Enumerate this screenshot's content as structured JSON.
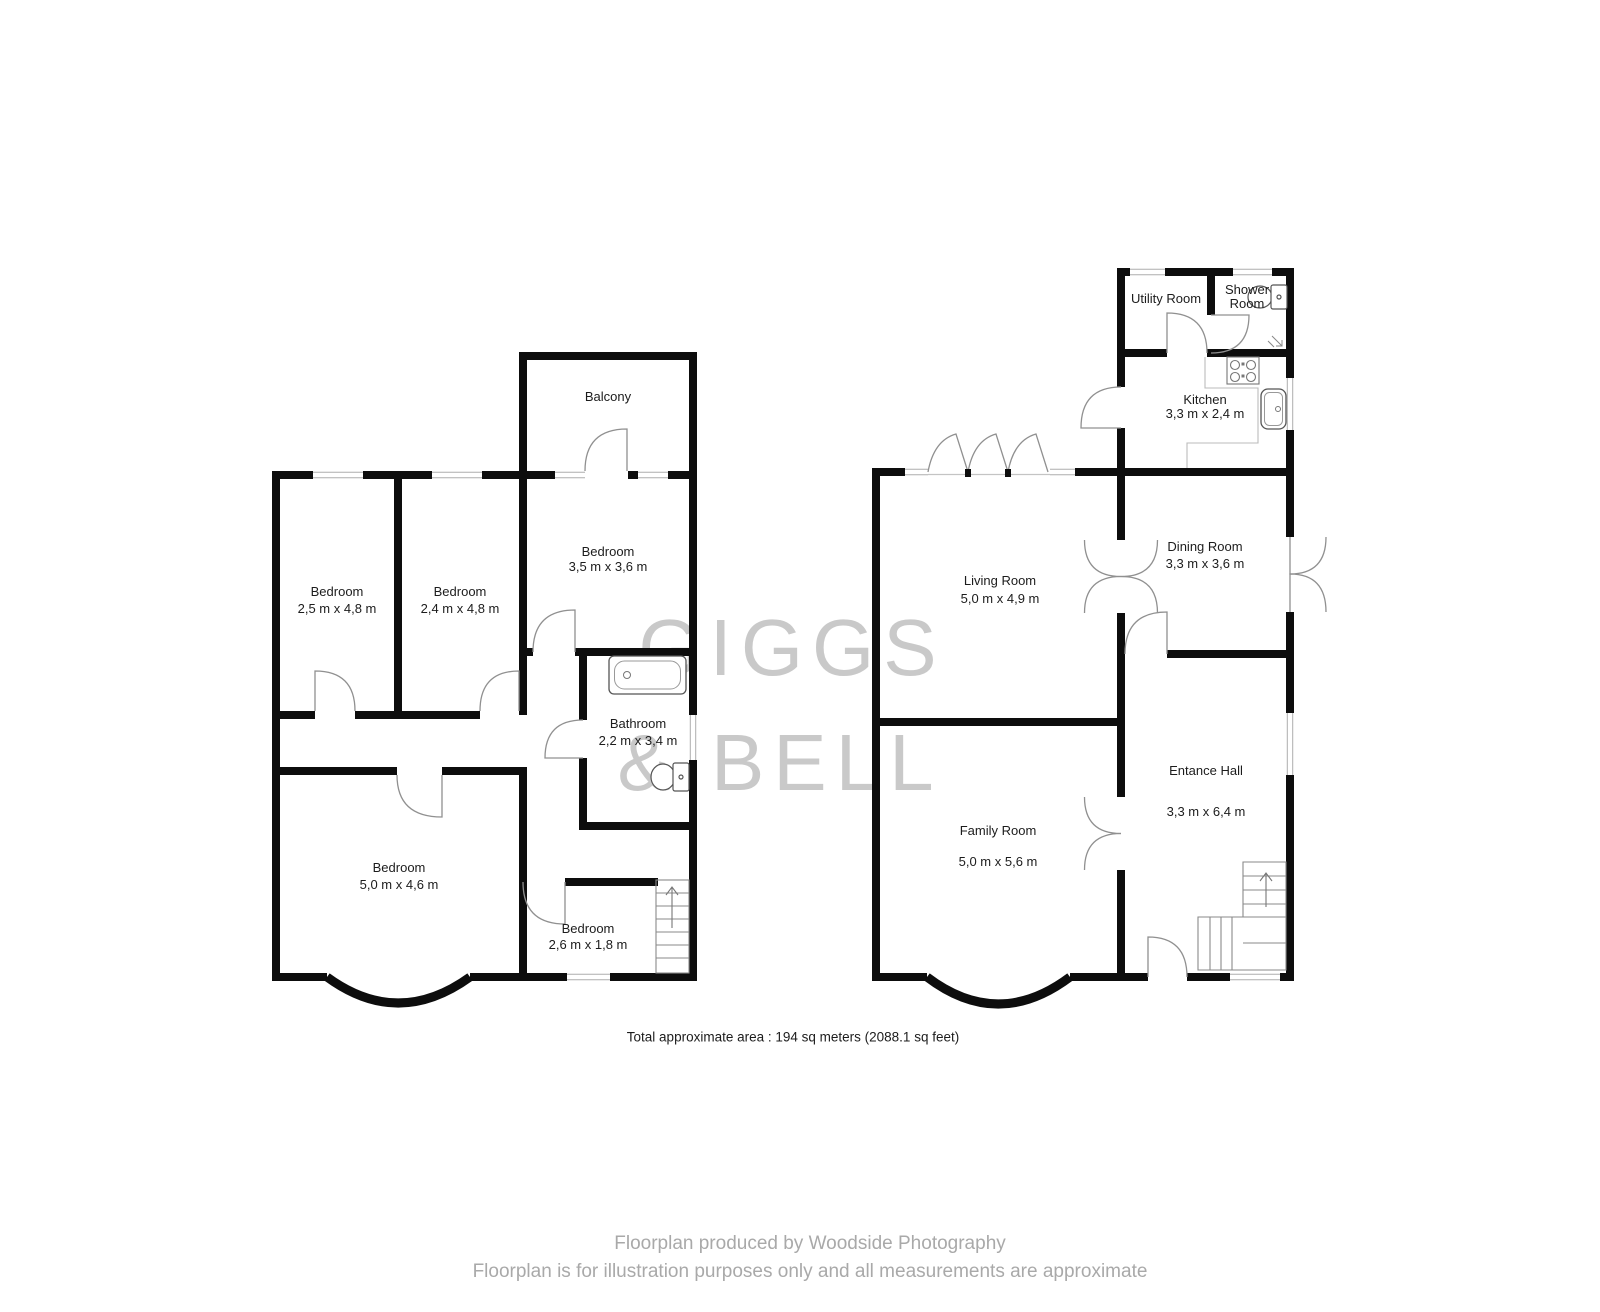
{
  "watermark": {
    "line1": "GIGGS",
    "line2": "& BELL",
    "color": "#c9c9c9"
  },
  "left_plan": {
    "rooms": [
      {
        "name": "Balcony",
        "dims": ""
      },
      {
        "name": "Bedroom",
        "dims": "2,5 m x 4,8 m"
      },
      {
        "name": "Bedroom",
        "dims": "2,4 m x 4,8 m"
      },
      {
        "name": "Bedroom",
        "dims": "3,5 m x 3,6 m"
      },
      {
        "name": "Bathroom",
        "dims": "2,2 m x 3,4 m"
      },
      {
        "name": "Bedroom",
        "dims": "5,0 m x 4,6 m"
      },
      {
        "name": "Bedroom",
        "dims": "2,6 m x 1,8 m"
      }
    ]
  },
  "right_plan": {
    "rooms": [
      {
        "name": "Utility Room",
        "dims": ""
      },
      {
        "name": "Shower Room",
        "dims": ""
      },
      {
        "name": "Kitchen",
        "dims": "3,3 m x 2,4 m"
      },
      {
        "name": "Dining Room",
        "dims": "3,3 m x 3,6 m"
      },
      {
        "name": "Living Room",
        "dims": "5,0 m x 4,9 m"
      },
      {
        "name": "Entance Hall",
        "dims": "3,3 m x 6,4 m"
      },
      {
        "name": "Family Room",
        "dims": "5,0 m x 5,6 m"
      }
    ]
  },
  "summary": {
    "total_area": "Total approximate area : 194 sq meters (2088.1 sq feet)"
  },
  "footer": {
    "credit": "Floorplan produced by Woodside Photography",
    "disclaimer": "Floorplan is for illustration purposes only and all measurements are approximate"
  },
  "icons": {
    "fixtures": [
      "bathtub-icon",
      "toilet-icon",
      "hob-icon",
      "sink-icon",
      "stairs-icon",
      "shower-drain-icon"
    ]
  },
  "colors": {
    "wall": "#0d0d0d",
    "door_arc": "#909090",
    "window_line": "#adadad"
  }
}
